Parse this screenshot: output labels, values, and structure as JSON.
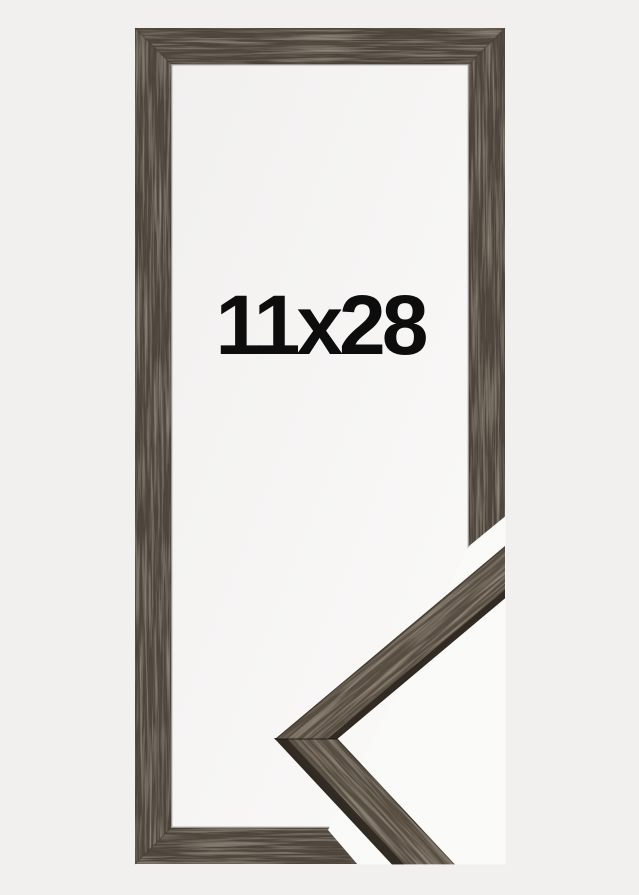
{
  "frame": {
    "size_label": "11x28"
  },
  "colors": {
    "background": "#f1f0ef",
    "opening_light": "#f1f0ef",
    "opening_bright": "#fbfaf9",
    "cutout_gap": "#fafaf9",
    "wood_base": "#4a4138",
    "wood_sample_base": "#52483e",
    "wood_dark_edge": "#2c2620",
    "label_text": "#0d0d0d"
  }
}
